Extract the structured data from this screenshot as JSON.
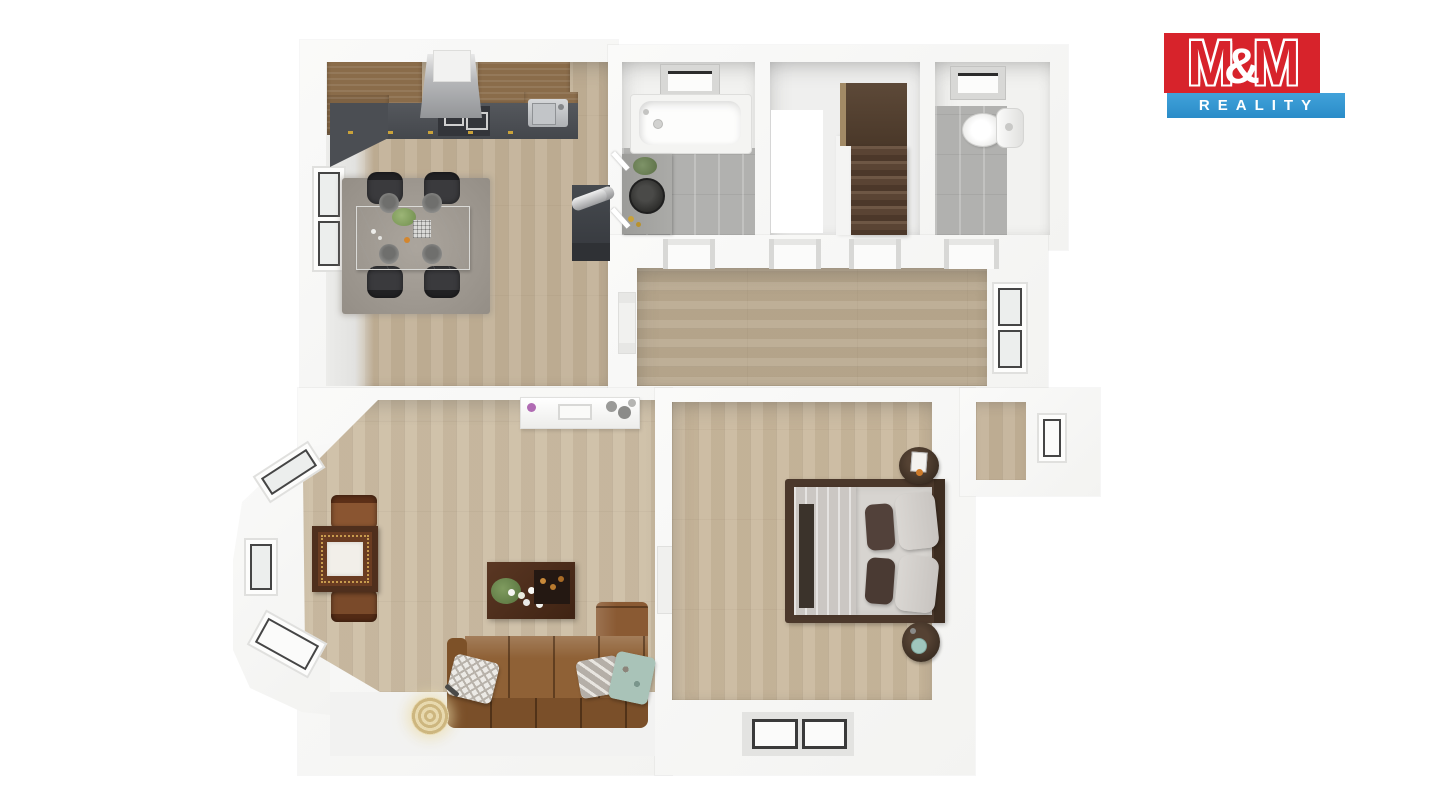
{
  "logo": {
    "m1": "M",
    "amp": "&",
    "m2": "M",
    "reality": "REALITY",
    "red": "#d7232b",
    "blue": "#2f97d4"
  },
  "floorplan": {
    "type": "3d-top-down-floor-plan",
    "background": "#ffffff",
    "rooms": [
      {
        "name": "kitchen-dining",
        "floor": "light-wood-vertical-planks",
        "features": [
          "upper-wood-cabinets",
          "range-hood",
          "dark-countertop",
          "cooktop",
          "stainless-sink",
          "gold-handles",
          "wood-stove-with-chimney-pipe",
          "grey-area-rug",
          "white-marble-dining-table",
          "four-dark-chairs",
          "left-wall-window"
        ]
      },
      {
        "name": "bathroom",
        "floor": "grey-tile",
        "features": [
          "bathtub",
          "skylight-window",
          "stone-vanity",
          "round-black-basin",
          "plant",
          "wall-mirror-strips"
        ]
      },
      {
        "name": "staircase-hall",
        "floor": "white",
        "features": [
          "upper-landing-platform",
          "dark-wood-stairs-down",
          "stairwell-opening",
          "dividing-wall-stub"
        ]
      },
      {
        "name": "wc",
        "floor": "grey-tile",
        "features": [
          "toilet-with-cistern",
          "skylight-window"
        ]
      },
      {
        "name": "hallway",
        "floor": "light-wood-horizontal-planks",
        "features": [
          "four-door-openings",
          "right-wall-window",
          "radiator"
        ]
      },
      {
        "name": "living-room",
        "floor": "light-wood-vertical-planks",
        "features": [
          "bay-with-three-windows",
          "ornate-writing-desk",
          "desk-blotter",
          "two-brown-chairs",
          "white-sideboard",
          "dark-coffee-table",
          "plants-and-flowers",
          "brown-leather-sofa",
          "herringbone-pillow",
          "zigzag-pillow",
          "teal-pillow",
          "rattan-floor-lamp"
        ]
      },
      {
        "name": "bedroom",
        "floor": "light-wood-vertical-planks",
        "features": [
          "double-bed-dark-frame",
          "grey-bedding",
          "folded-blanket",
          "dark-bed-runner",
          "four-pillows",
          "two-round-nightstands",
          "alarm-clock",
          "teal-cup",
          "bottom-wall-window"
        ]
      },
      {
        "name": "alcove",
        "floor": "light-wood",
        "features": [
          "right-wall-window"
        ]
      }
    ],
    "palette": {
      "wood": "#c6b499",
      "wood_hall": "#b9a98f",
      "tile": "#b1b1af",
      "wall": "#f6f6f5",
      "counter": "#4b4e53",
      "cabinet_wood": "#8a6c4a",
      "sofa_leather": "#8a5c36",
      "bed_frame": "#4b382b",
      "stairs_wood": "#5a4434",
      "rug": "#a19b93"
    }
  }
}
